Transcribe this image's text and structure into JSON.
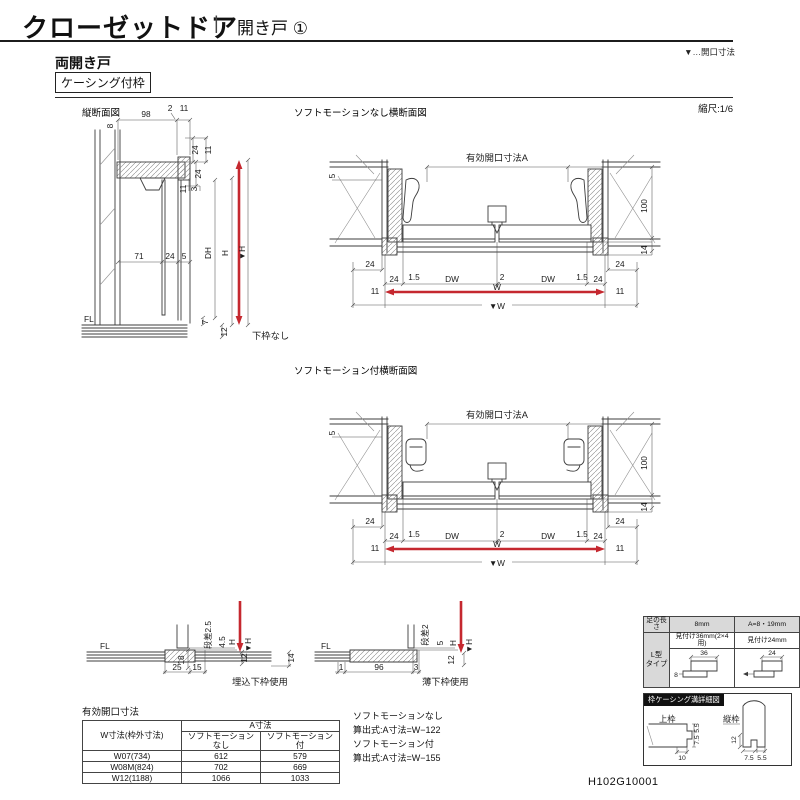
{
  "header": {
    "title": "クローゼットドア",
    "divider": "|",
    "category": "開き戸 ①",
    "legend_note": "▼…開口寸法"
  },
  "section": {
    "door_type": "両開き戸",
    "frame_type": "ケーシング付枠",
    "scale": "縮尺:1/6"
  },
  "doc_number": "H102G10001",
  "fig_vertical": {
    "title": "縦断面図",
    "note": "下枠なし",
    "fl": "FL",
    "dims": {
      "t98": "98",
      "t2": "2",
      "t11": "11",
      "l8": "8",
      "ra24": "24",
      "ra11": "11",
      "rb24": "24",
      "rc11": "11",
      "rc3": "3",
      "m71": "71",
      "m24": "24",
      "m5": "5",
      "dh": "DH",
      "h": "H",
      "vh": "▼H",
      "g7": "7",
      "f12": "12"
    }
  },
  "fig_plan_nosoft": {
    "title": "ソフトモーションなし横断面図",
    "dims": {
      "a": "有効開口寸法A",
      "s5": "5",
      "h100": "100",
      "h14": "14",
      "lo24": "24",
      "li24": "24",
      "l15": "1.5",
      "dw1": "DW",
      "c2": "2",
      "dw2": "DW",
      "r15": "1.5",
      "ri24": "24",
      "ro24": "24",
      "l11": "11",
      "r11": "11",
      "w": "W",
      "vw": "▼W"
    }
  },
  "fig_plan_soft": {
    "title": "ソフトモーション付横断面図",
    "dims": {
      "a": "有効開口寸法A",
      "s5": "5",
      "h100": "100",
      "h14": "14",
      "lo24": "24",
      "li24": "24",
      "l15": "1.5",
      "dw1": "DW",
      "c2": "2",
      "dw2": "DW",
      "r15": "1.5",
      "ri24": "24",
      "ro24": "24",
      "l11": "11",
      "r11": "11",
      "w": "W",
      "vw": "▼W"
    }
  },
  "fig_sill_recessed": {
    "title": "埋込下枠使用",
    "fl": "FL",
    "dims": {
      "step": "段差2.5",
      "d45": "4.5",
      "h": "H",
      "vh": "▼H",
      "d12": "12",
      "d14": "14",
      "d18": "18",
      "d25": "25",
      "d15": "15"
    }
  },
  "fig_sill_thin": {
    "title": "薄下枠使用",
    "fl": "FL",
    "dims": {
      "step": "段差2",
      "d5": "5",
      "h": "H",
      "vh": "▼H",
      "d12": "12",
      "d1": "1",
      "d96": "96",
      "d3": "3"
    }
  },
  "opening_table": {
    "title": "有効開口寸法",
    "col_w": "W寸法(枠外寸法)",
    "col_a": "A寸法",
    "col_nosoft": "ソフトモーションなし",
    "col_soft": "ソフトモーション付",
    "rows": [
      {
        "w": "W07(734)",
        "nosoft": "612",
        "soft": "579"
      },
      {
        "w": "W08M(824)",
        "nosoft": "702",
        "soft": "669"
      },
      {
        "w": "W12(1188)",
        "nosoft": "1066",
        "soft": "1033"
      }
    ]
  },
  "formulas": {
    "nosoft_label": "ソフトモーションなし",
    "nosoft_formula": "算出式:A寸法=W−122",
    "soft_label": "ソフトモーション付",
    "soft_formula": "算出式:A寸法=W−155"
  },
  "casing_table": {
    "corner_label": "足の長さ",
    "col1": "8mm",
    "col2": "A=8・19mm",
    "row_label_1": "L型",
    "row_label_2": "タイプ",
    "cell1_note": "見付け36mm(2×4用)",
    "cell2_note": "見付け24mm",
    "cell1_dim": "36",
    "cell2_dim": "24",
    "cell1_foot": "8"
  },
  "casing_detail": {
    "title": "枠ケーシング溝詳細図",
    "upper_label": "上枠",
    "side_label": "縦枠",
    "u55": "5.5",
    "u75": "7.5",
    "u10": "10",
    "s12": "12",
    "s75": "7.5",
    "s55": "5.5"
  },
  "colors": {
    "accent_red": "#c5282f",
    "line": "#3c3c3c"
  }
}
